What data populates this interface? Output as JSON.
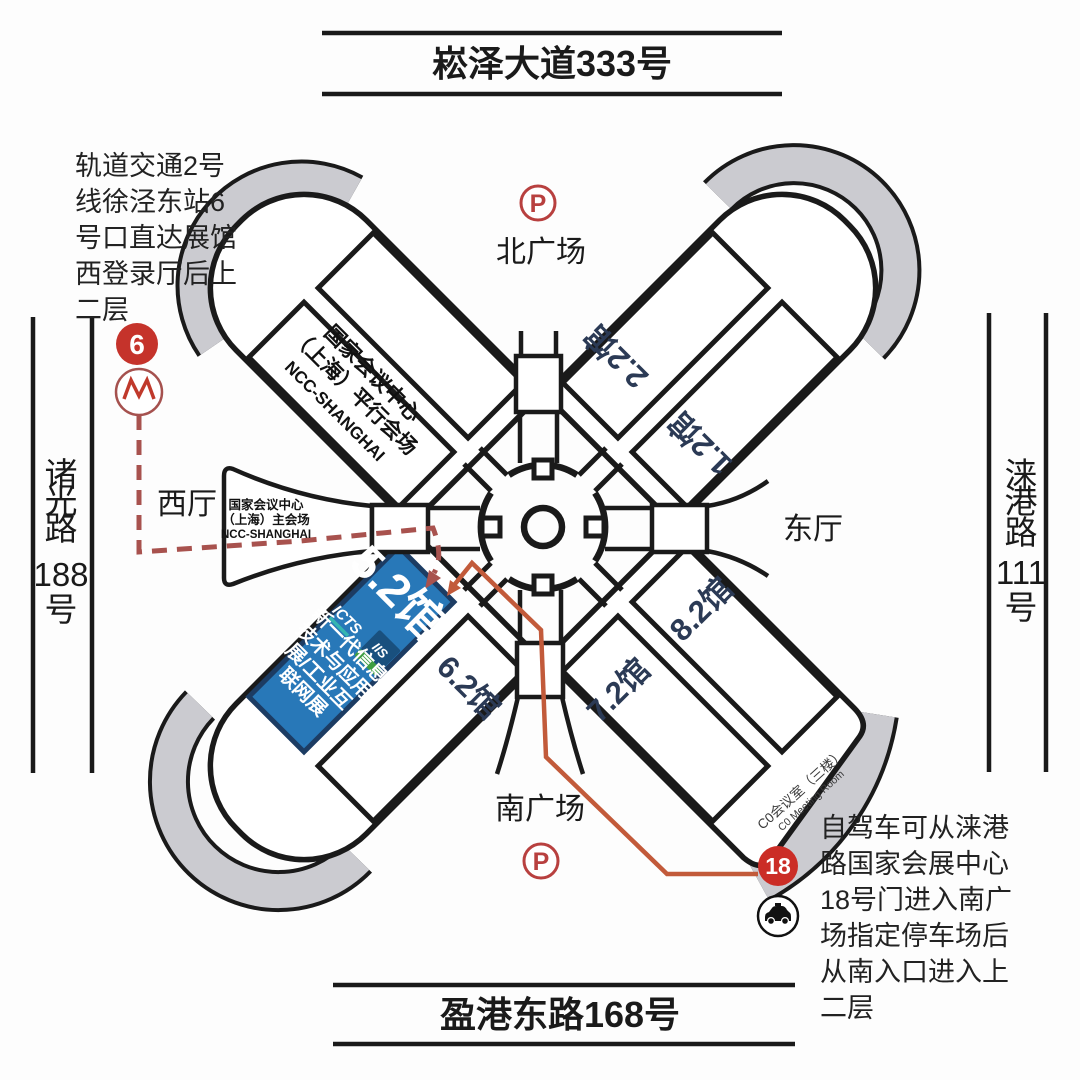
{
  "roads": {
    "north": "崧泽大道333号",
    "south": "盈港东路168号",
    "west_chars": [
      "诸",
      "光",
      "路",
      "188",
      "号"
    ],
    "east_chars": [
      "涞",
      "港",
      "路",
      "111",
      "号"
    ]
  },
  "metro_note_lines": [
    "轨道交通2号",
    "线徐泾东站6",
    "号口直达展馆",
    "西登录厅后上",
    "二层"
  ],
  "drive_note_lines": [
    "自驾车可从涞港",
    "路国家会展中心",
    "18号门进入南广",
    "场指定停车场后",
    "从南入口进入上",
    "二层"
  ],
  "badges": {
    "metro_line": "6",
    "gate": "18",
    "parking_north": "P",
    "parking_south": "P"
  },
  "plazas": {
    "north": "北广场",
    "south": "南广场"
  },
  "lobbies": {
    "west": "西厅",
    "east": "东厅"
  },
  "halls": {
    "h22": "2.2馆",
    "h12": "1.2馆",
    "h82": "8.2馆",
    "h72": "7.2馆",
    "h62": "6.2馆",
    "h52": "5.2馆"
  },
  "ncc_parallel": [
    "国家会议中心",
    "（上海）平行会场",
    "NCC-SHANGHAI"
  ],
  "ncc_main": [
    "国家会议中心",
    "（上海）主会场",
    "NCC-SHANGHAI"
  ],
  "hall52": {
    "logo_icts": "ICTS",
    "logo_iis": "IIS",
    "lines": [
      "新一代信息",
      "技术与应用",
      "展/工业互",
      "联网展"
    ]
  },
  "meeting_room": [
    "C0会议室（三楼）",
    "C0 Meeting Room"
  ],
  "colors": {
    "badge_red": "#c5332b",
    "parking_red": "#b8403f",
    "route_solid": "#c25a3a",
    "route_dashed": "#a8524e",
    "hall_blue": "#2878b8",
    "hall_text_navy": "#2b3a55",
    "gray_band": "#cbcbd0",
    "outline": "#1a1a1a"
  }
}
